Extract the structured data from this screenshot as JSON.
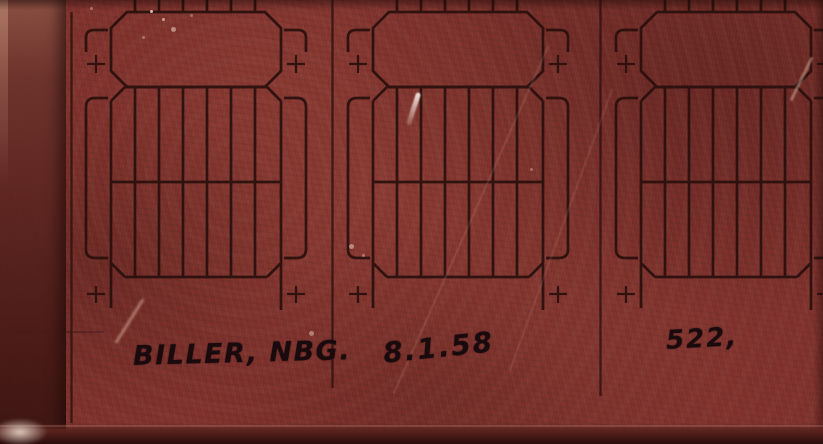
{
  "annotations": {
    "author": "BILLER, NBG.",
    "date": "8.1.58",
    "sheet_number": "522,"
  },
  "drawing": {
    "type": "technical-schematic-film",
    "panel_count": 3,
    "comb_teeth_per_panel": 6
  },
  "colors": {
    "film_base": "#7e302b",
    "line_ink": "#2a100d",
    "annotation_ink": "#190a0e",
    "edge_shadow": "#2a0d0b"
  }
}
